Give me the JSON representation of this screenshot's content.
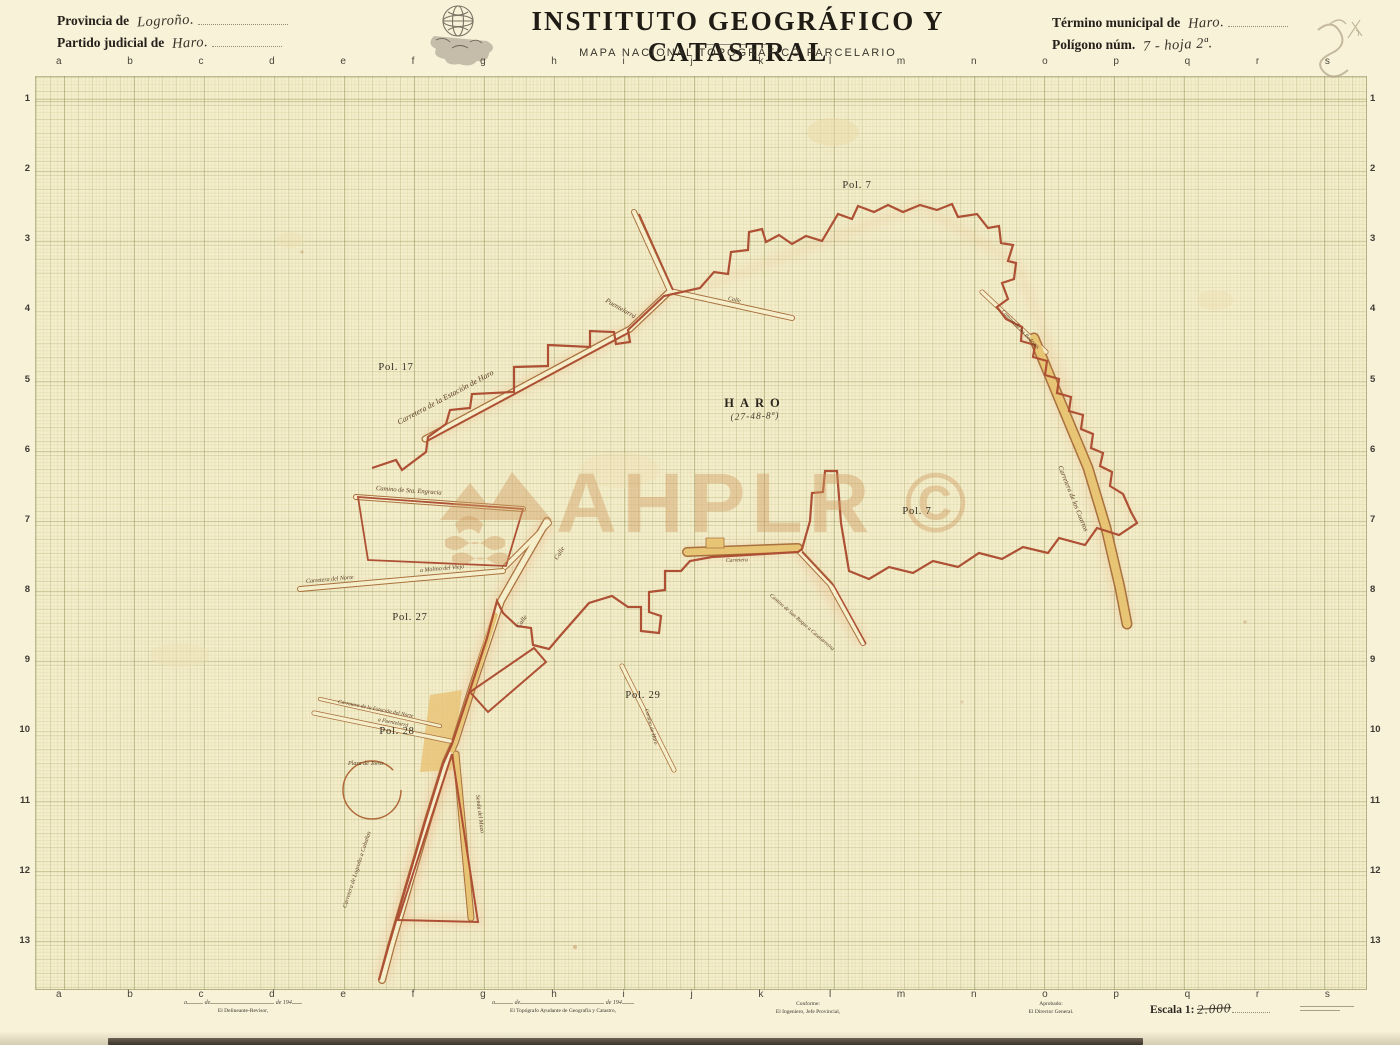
{
  "header": {
    "provincia_label": "Provincia de",
    "provincia_value": "Logroño.",
    "partido_label": "Partido judicial de",
    "partido_value": "Haro.",
    "title": "INSTITUTO GEOGRÁFICO Y CATASTRAL",
    "subtitle": "MAPA NACIONAL TOPOGRÁFICO PARCELARIO",
    "termino_label": "Término municipal de",
    "termino_value": "Haro.",
    "poligono_label": "Polígono núm.",
    "poligono_value": "7 - hoja 2ª."
  },
  "grid": {
    "column_letters": [
      "a",
      "b",
      "c",
      "d",
      "e",
      "f",
      "g",
      "h",
      "i",
      "j",
      "k",
      "l",
      "m",
      "n",
      "o",
      "p",
      "q",
      "r",
      "s"
    ],
    "row_numbers": [
      "1",
      "2",
      "3",
      "4",
      "5",
      "6",
      "7",
      "8",
      "9",
      "10",
      "11",
      "12",
      "13"
    ]
  },
  "map": {
    "town_label": "HARO",
    "town_coords": "(27-48-8ª)",
    "polygon_labels": [
      {
        "text": "Pol. 7"
      },
      {
        "text": "Pol. 17"
      },
      {
        "text": "Pol. 27"
      },
      {
        "text": "Pol. 28"
      },
      {
        "text": "Pol. 29"
      },
      {
        "text": "Pol. 7"
      }
    ],
    "road_labels": [
      {
        "text": "Carretera de la Estación de Haro"
      },
      {
        "text": "Puentelarrá"
      },
      {
        "text": "Calle"
      },
      {
        "text": "Camino de Sta. Engracia"
      },
      {
        "text": "Carretera del Norte"
      },
      {
        "text": "a Molino del Viejo"
      },
      {
        "text": "Calle"
      },
      {
        "text": "Calle"
      },
      {
        "text": "Senda del Mazo"
      },
      {
        "text": "Carretera"
      },
      {
        "text": "Camino de San Roque a Casalarreina"
      },
      {
        "text": "Carretera de los Cuartos"
      },
      {
        "text": "Carretera de Logroño a Cabañas"
      },
      {
        "text": "Plaza de Toros"
      },
      {
        "text": "Camino de las Bodegas"
      },
      {
        "text": "Carretera de la Estación del Norte"
      },
      {
        "text": "a Puentelarrá"
      },
      {
        "text": "Camino de Haro"
      }
    ]
  },
  "watermark": {
    "text": "AHPLR ©"
  },
  "footer": {
    "date_blank_1": "a",
    "date_blank_2": "de",
    "date_blank_3": "de 194",
    "signature_1": "El Delineante-Revisor,",
    "signature_2": "El Topógrafo Ayudante de Geografía y Catastro,",
    "conforme_label": "Conforme:",
    "conforme_signature": "El Ingeniero, Jefe Provincial,",
    "aprobado_label": "Aprobado:",
    "aprobado_signature": "El Director General.",
    "escala_label": "Escala 1:",
    "escala_value": "2.000"
  },
  "colors": {
    "paper": "#f5eecb",
    "boundary_red": "#ad5034",
    "road_brown": "#a8713d",
    "road_tan": "#e8c475",
    "watermark_tan": "#cf9d61",
    "ink": "#25201a"
  }
}
